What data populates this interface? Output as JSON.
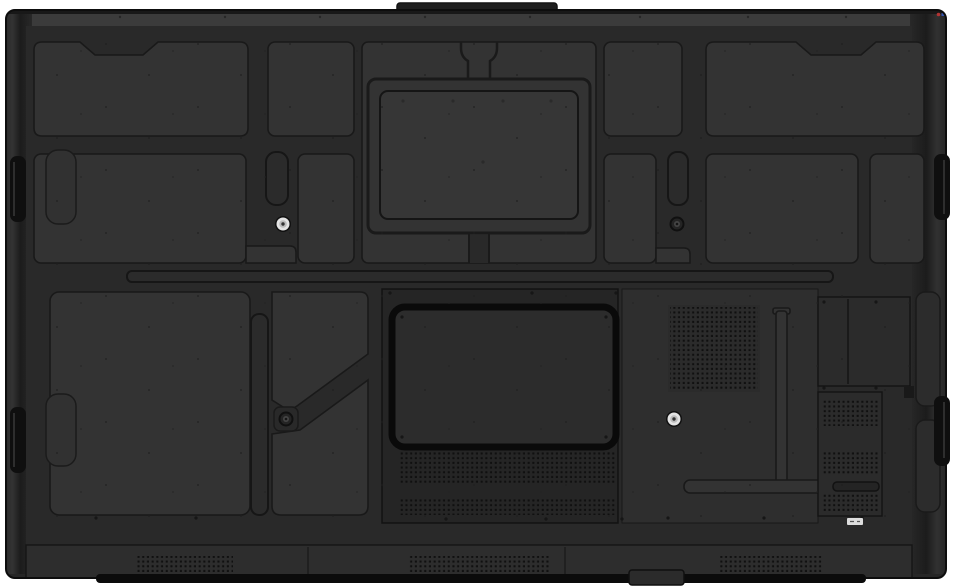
{
  "meta": {
    "subject": "rear-view-of-interactive-flat-panel-display",
    "width_px": 960,
    "height_px": 587
  },
  "colors": {
    "background": "#ffffff",
    "body": "#262626",
    "base": "#292929",
    "panel": "#333333",
    "panel_light": "#363636",
    "plate": "#252525",
    "recess": "#2b2b2b",
    "groove": "#191919",
    "edge": "#0e0e0e",
    "top_cap": "#3b3b3b",
    "bottom_strip": "#2d2d2d",
    "handle": "#0f0f0f",
    "bay_fill": "#2c2c2c",
    "bay_border": "#0a0a0a",
    "screw_silver": "#e4e4e4",
    "screw_dark": "#454545",
    "sticker": "#dddddd",
    "logo_red": "#b23333",
    "logo_blue": "#3656b3",
    "bottom_bar": "#0b0b0b"
  },
  "parts": {
    "top_block": "camera-mount-block",
    "vesa_plate": "vesa-mount-plate",
    "ports_bay": "ports-compartment",
    "speaker_square": "subwoofer-grille",
    "bottom_grilles": "speaker-grilles",
    "vent_panel": "side-vent-panel",
    "handle_tabs": "side-handle-slots",
    "cable_slot": "cable-routing-slot",
    "foot": "bottom-foot",
    "sticker": "serial-label"
  },
  "screws": [
    {
      "x": 283,
      "y": 224,
      "type": "silver"
    },
    {
      "x": 677,
      "y": 224,
      "type": "dark"
    },
    {
      "x": 286,
      "y": 419,
      "type": "dark"
    },
    {
      "x": 674,
      "y": 419,
      "type": "silver"
    }
  ],
  "grilles": [
    {
      "x": 399,
      "y": 452,
      "w": 216,
      "h": 32
    },
    {
      "x": 399,
      "y": 498,
      "w": 216,
      "h": 17
    },
    {
      "x": 670,
      "y": 307,
      "w": 88,
      "h": 83
    },
    {
      "x": 822,
      "y": 399,
      "w": 56,
      "h": 27
    },
    {
      "x": 822,
      "y": 451,
      "w": 56,
      "h": 24
    },
    {
      "x": 822,
      "y": 494,
      "w": 56,
      "h": 17
    },
    {
      "x": 137,
      "y": 556,
      "w": 96,
      "h": 17
    },
    {
      "x": 408,
      "y": 556,
      "w": 142,
      "h": 17
    },
    {
      "x": 718,
      "y": 556,
      "w": 104,
      "h": 17
    }
  ],
  "screw_dots": [
    {
      "x": 96,
      "y": 518
    },
    {
      "x": 196,
      "y": 518
    },
    {
      "x": 446,
      "y": 519
    },
    {
      "x": 546,
      "y": 519
    },
    {
      "x": 622,
      "y": 519
    },
    {
      "x": 668,
      "y": 518
    },
    {
      "x": 764,
      "y": 518
    },
    {
      "x": 862,
      "y": 518
    },
    {
      "x": 390,
      "y": 293
    },
    {
      "x": 532,
      "y": 293
    },
    {
      "x": 616,
      "y": 293
    },
    {
      "x": 402,
      "y": 317
    },
    {
      "x": 606,
      "y": 317
    },
    {
      "x": 402,
      "y": 437
    },
    {
      "x": 606,
      "y": 437
    },
    {
      "x": 824,
      "y": 302
    },
    {
      "x": 876,
      "y": 302
    },
    {
      "x": 824,
      "y": 388
    },
    {
      "x": 876,
      "y": 388
    }
  ],
  "vesa_holes": [
    {
      "x": 403,
      "y": 101
    },
    {
      "x": 453,
      "y": 101
    },
    {
      "x": 503,
      "y": 101
    },
    {
      "x": 551,
      "y": 101
    },
    {
      "x": 483,
      "y": 162
    }
  ],
  "cap_screws_y": 17,
  "cap_screws_x": [
    120,
    225,
    320,
    425,
    530,
    640,
    748,
    846
  ]
}
